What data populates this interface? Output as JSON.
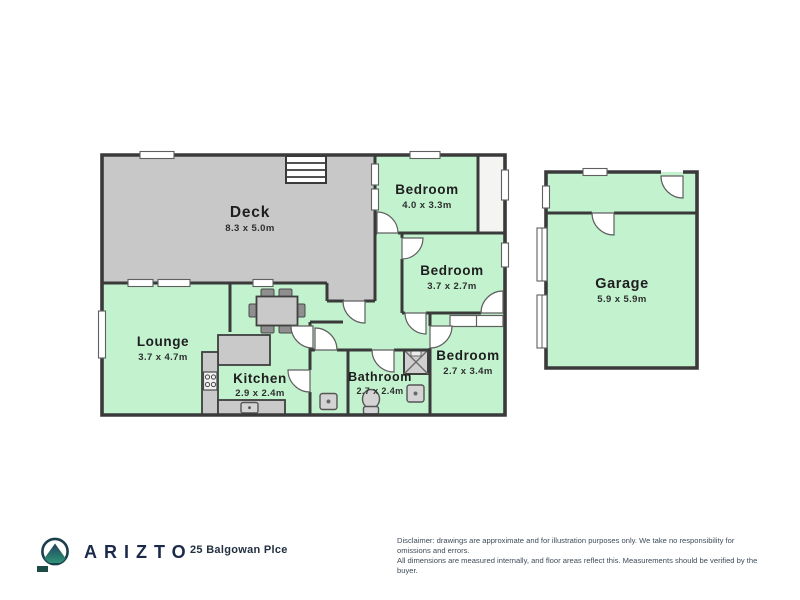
{
  "plan": {
    "rooms": {
      "deck": {
        "name": "Deck",
        "dims": "8.3 x 5.0m"
      },
      "bedroom1": {
        "name": "Bedroom",
        "dims": "4.0 x 3.3m"
      },
      "bedroom2": {
        "name": "Bedroom",
        "dims": "3.7 x 2.7m"
      },
      "bedroom3": {
        "name": "Bedroom",
        "dims": "2.7 x 3.4m"
      },
      "lounge": {
        "name": "Lounge",
        "dims": "3.7 x 4.7m"
      },
      "kitchen": {
        "name": "Kitchen",
        "dims": "2.9 x 2.4m"
      },
      "bathroom": {
        "name": "Bathroom",
        "dims": "2.7 x 2.4m"
      },
      "garage": {
        "name": "Garage",
        "dims": "5.9 x 5.9m"
      }
    },
    "colors": {
      "room_fill": "#c3f2cf",
      "deck_fill": "#c8c8c8",
      "wall": "#3a3a3a",
      "brand_navy": "#1b2a4a",
      "logo_teal": "#2e9277"
    }
  },
  "footer": {
    "brand": "ARIZTO",
    "address": "25 Balgowan Plce",
    "disclaimer_line1": "Disclaimer: drawings are approximate and for illustration purposes only. We take no responsibility for omissions and errors.",
    "disclaimer_line2": "All dimensions are measured internally, and floor areas reflect this. Measurements should be verified by the buyer."
  }
}
